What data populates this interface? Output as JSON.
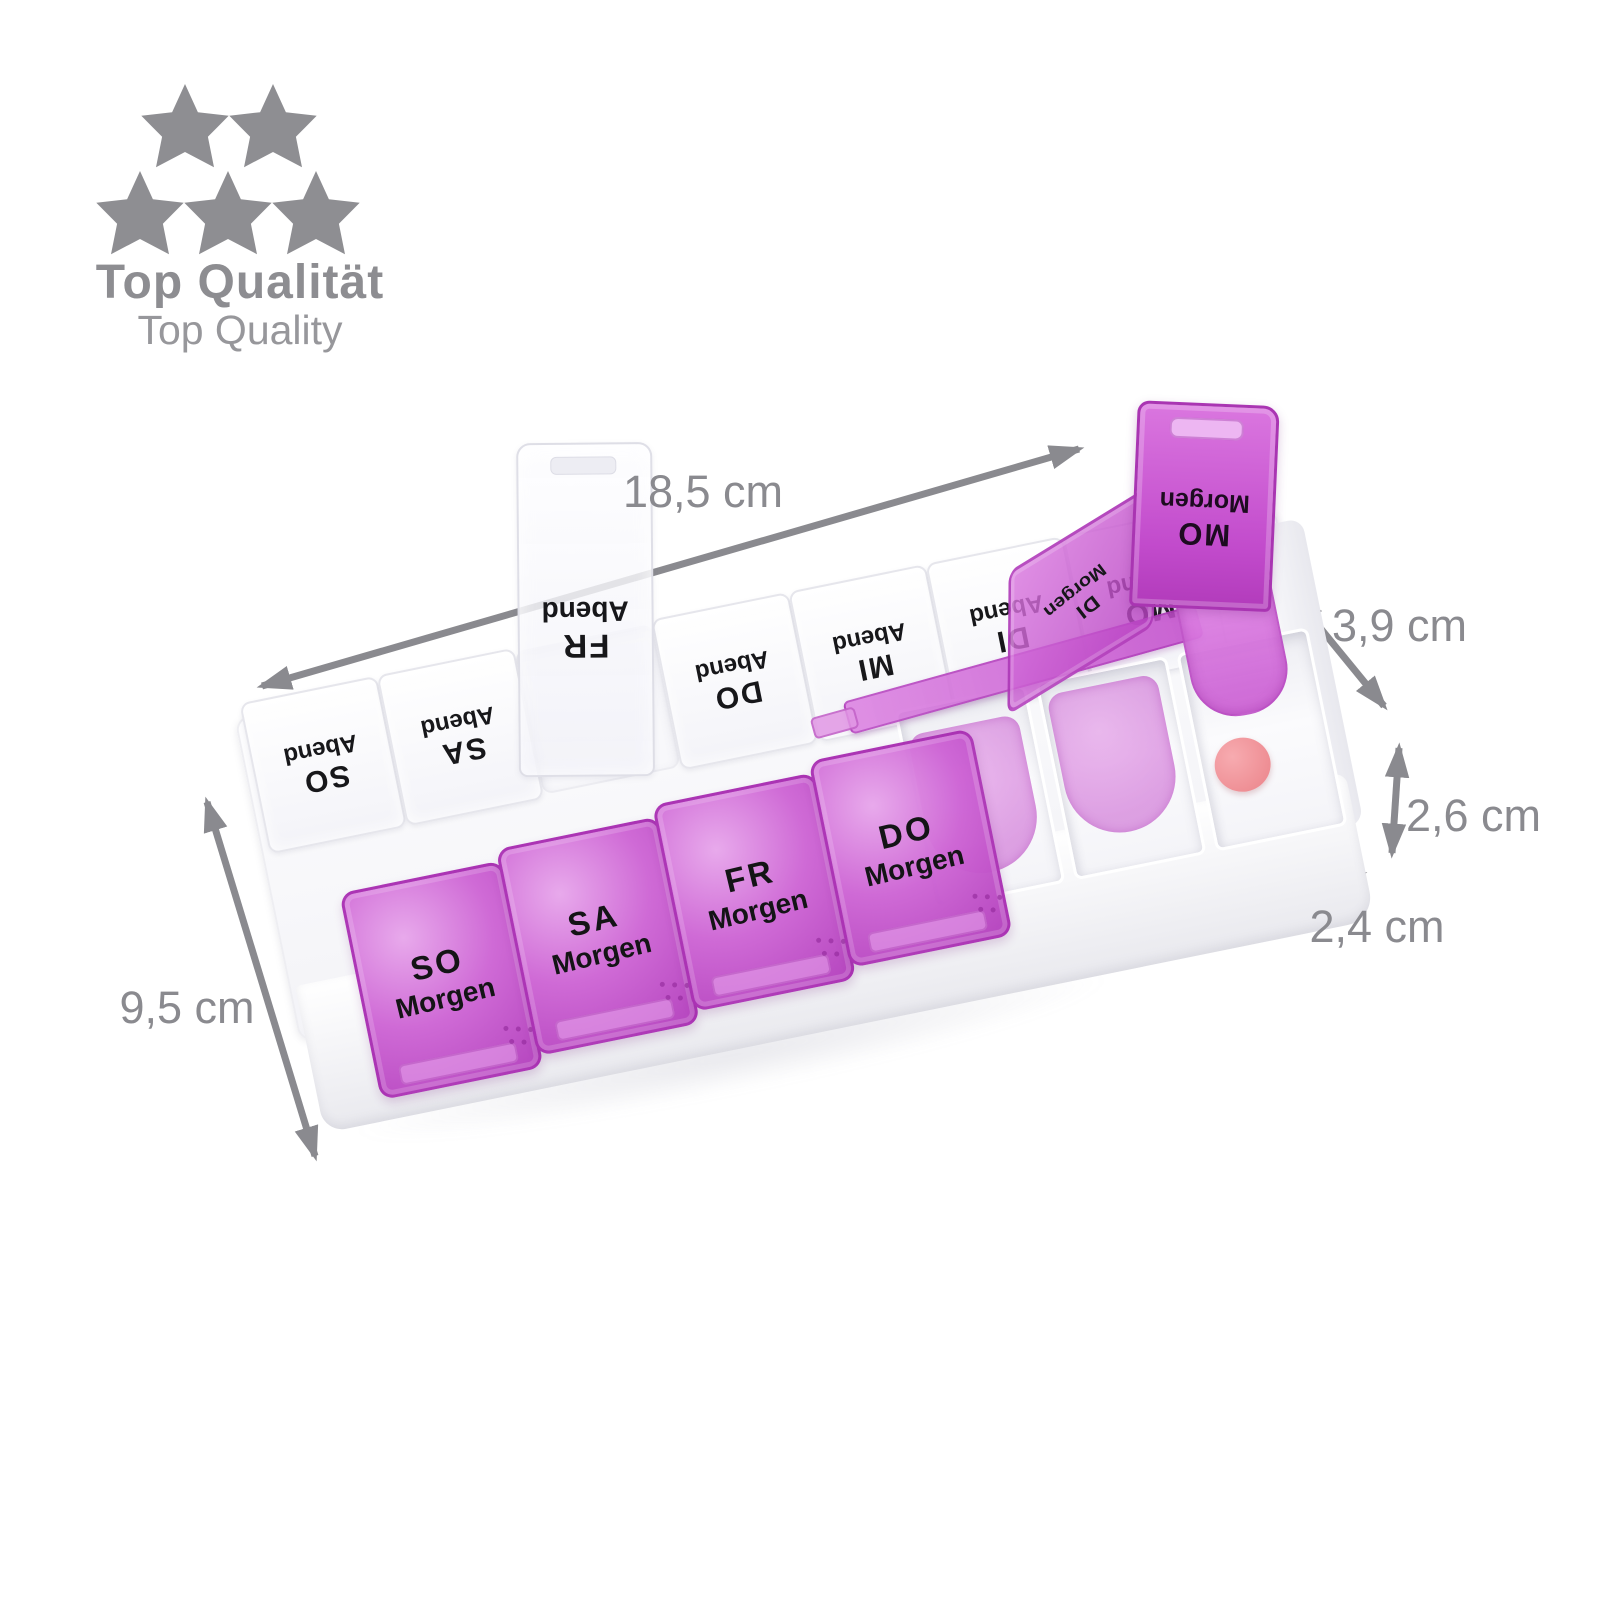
{
  "badge": {
    "title": "Top Qualität",
    "subtitle": "Top Quality",
    "star_count": 5,
    "star_color": "#8e8e92"
  },
  "dimensions": {
    "width_label": "18,5 cm",
    "depth_label": "9,5 cm",
    "lid_height_label": "3,9 cm",
    "base_height_label": "2,6 cm",
    "compartment_width_label": "2,4 cm",
    "arrow_color": "#8a8a8f"
  },
  "organizer": {
    "abend_row": {
      "lids": [
        {
          "day": "SO",
          "time": "Abend",
          "state": "closed"
        },
        {
          "day": "SA",
          "time": "Abend",
          "state": "closed"
        },
        {
          "day": "FR",
          "time": "Abend",
          "state": "open-upright"
        },
        {
          "day": "DO",
          "time": "Abend",
          "state": "closed"
        },
        {
          "day": "MI",
          "time": "Abend",
          "state": "closed"
        },
        {
          "day": "DI",
          "time": "Abend",
          "state": "closed"
        },
        {
          "day": "MO",
          "time": "Abend",
          "state": "closed"
        }
      ]
    },
    "morgen_row": {
      "lids": [
        {
          "day": "SO",
          "time": "Morgen",
          "state": "closed"
        },
        {
          "day": "SA",
          "time": "Morgen",
          "state": "closed"
        },
        {
          "day": "FR",
          "time": "Morgen",
          "state": "closed"
        },
        {
          "day": "DO",
          "time": "Morgen",
          "state": "closed"
        },
        {
          "day": "MI",
          "time": "Morgen",
          "state": "open-flat"
        },
        {
          "day": "DI",
          "time": "Morgen",
          "state": "open-tilted"
        },
        {
          "day": "MO",
          "time": "Morgen",
          "state": "open-upright"
        }
      ]
    },
    "colors": {
      "lid_purple": "#cb63cf",
      "lid_purple_dark": "#a935b2",
      "lid_white": "#fbfbfd",
      "tray": "#f4f4f8",
      "pill": "#ee8d93",
      "label_text": "#141416"
    }
  }
}
